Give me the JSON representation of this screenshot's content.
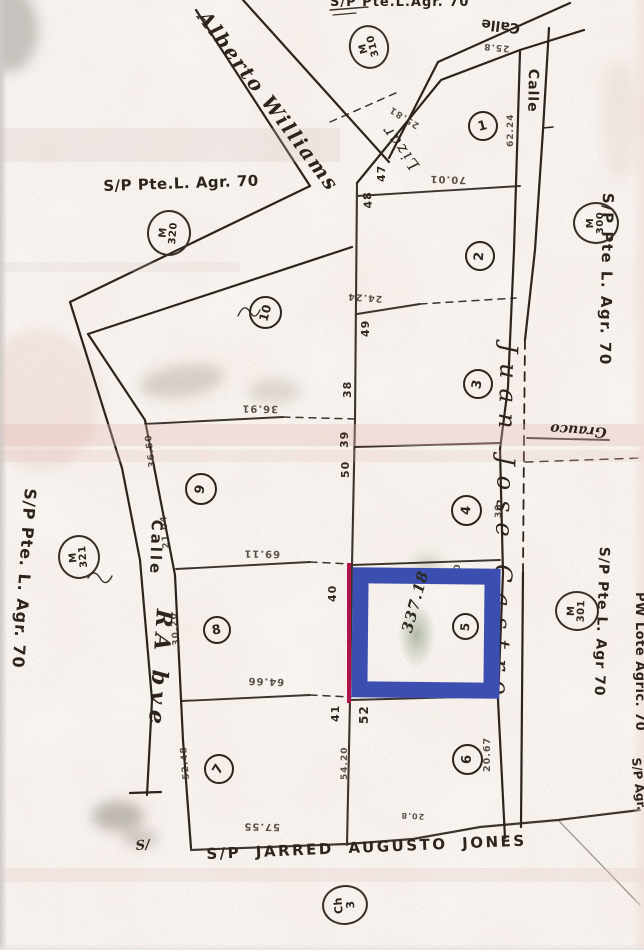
{
  "colors": {
    "highlight_blue": "#3c4eb0",
    "highlight_red_line": "#b0124b",
    "ink": "#2e241c",
    "paper": "#f8f5f1"
  },
  "streets": {
    "alberto_williams": "Alberto Williams",
    "calle_top": "Calle",
    "calle_right": "Calle",
    "calle_left": "Calle",
    "rabve": "RA bve",
    "lizar": "Lizar",
    "juan_jose_castro": "Juan Jose Castro",
    "grauco": "Grauco"
  },
  "boundary_labels": {
    "top_clipped": "S/P Pte.L.Agr. 70",
    "left_block": "S/P Pte.L. Agr. 70",
    "right_top": "S/P Pte L. Agr. 70",
    "right_mid": "S/P Pte L. Agr 70",
    "right_edge": "PW Lote Agric. 70",
    "right_edge_bottom": "S/P Agr.",
    "left_edge": "S/P Pte. L. Agr. 70",
    "bottom": "S/P JARRED AUGUSTO JONES",
    "bottom_left_partial": "S/"
  },
  "lots": {
    "l1": "1",
    "l2": "2",
    "l3": "3",
    "l4": "4",
    "l5": "5",
    "l6": "6",
    "l7": "7",
    "l8": "8",
    "l9": "9",
    "l10": "10"
  },
  "stamps": {
    "m310": {
      "l1": "M",
      "l2": "310"
    },
    "m320": {
      "l1": "M",
      "l2": "320"
    },
    "m300": {
      "l1": "M",
      "l2": "300"
    },
    "m321": {
      "l1": "M",
      "l2": "321"
    },
    "m301": {
      "l1": "M",
      "l2": "301"
    },
    "ch3": {
      "l1": "Ch",
      "l2": "3"
    }
  },
  "measurements": {
    "center_line": {
      "m47": "47",
      "m48": "48",
      "m49": "49",
      "m38": "38",
      "m39": "39",
      "m50": "50",
      "m40": "40",
      "m41": "41",
      "m52": "52",
      "m5420": "54.20"
    },
    "upside": {
      "m258": "25.8",
      "m2581": "25.81",
      "m7001": "70.01",
      "m2424": "24.24",
      "m3691": "36.91",
      "m6911": "69.11",
      "m6466": "64.66",
      "m5755": "57.55",
      "m208": "20.8"
    },
    "left_road": {
      "m3650": "36.50",
      "m2104": "21.04",
      "m3020": "30.20",
      "m5248": "52.48"
    },
    "right_side": {
      "m6224": "62.24",
      "m30a": "30",
      "m30b": "30",
      "m2067": "20.67"
    }
  },
  "highlight": {
    "handwritten_area": "337.18"
  }
}
